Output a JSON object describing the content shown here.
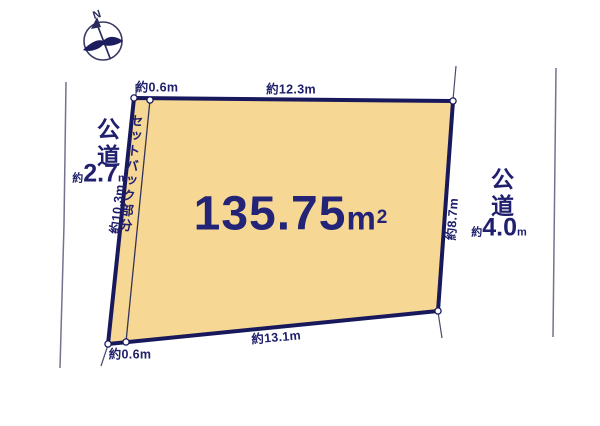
{
  "diagram": {
    "type": "land-plot-layout",
    "background": "#ffffff",
    "colors": {
      "plot_fill": "#f6d793",
      "boundary_navy": "#18185c",
      "text_navy": "#20206e",
      "far_road_line": "#73738e",
      "thin_line": "#4a4a70",
      "corner_dot_fill": "#ffffff"
    }
  },
  "compass": {
    "label": "N"
  },
  "plot": {
    "area_value": "135.75",
    "area_unit": "m",
    "area_exp": "2",
    "setback_label": "セットバック部分",
    "dimensions": {
      "top_setback_width": "約0.6m",
      "top_edge": "約12.3m",
      "left_edge": "約10.3m",
      "right_edge": "約8.7m",
      "bottom_edge": "約13.1m",
      "bottom_setback_width": "約0.6m"
    }
  },
  "roads": {
    "left": {
      "name": "公道",
      "width_prefix": "約",
      "width_value": "2.7",
      "width_unit": "m"
    },
    "right": {
      "name": "公道",
      "width_prefix": "約",
      "width_value": "4.0",
      "width_unit": "m"
    }
  }
}
